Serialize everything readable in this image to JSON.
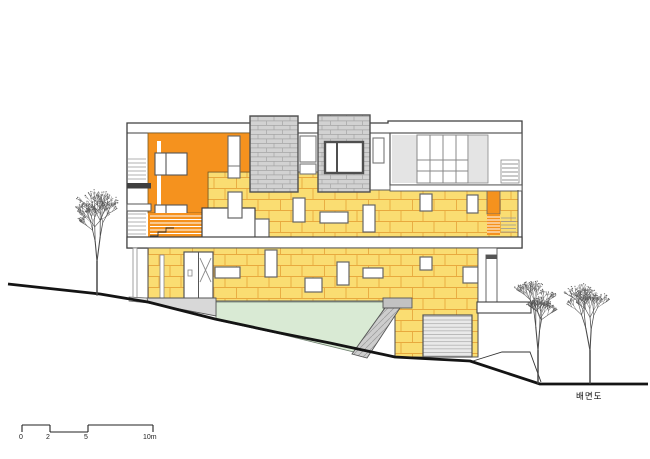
{
  "drawing": {
    "label": "배면도",
    "scale_bar": {
      "tick_labels": [
        "0",
        "2",
        "5",
        "10m"
      ]
    }
  },
  "colors": {
    "wall_yellow": "#FADD72",
    "block_joint": "#E8A93E",
    "accent_orange": "#F5921E",
    "masonry_gray": "#D2D2D2",
    "masonry_joint": "#A5A5A5",
    "glass_gray": "#E4E4E4",
    "ramp_green": "#D9EAD4",
    "garage_gray": "#E9E9E9",
    "concrete_gray": "#CDCDCD",
    "line_dark": "#3F3F3F",
    "ground_black": "#141414",
    "tree_stroke": "#4A4A4A"
  }
}
